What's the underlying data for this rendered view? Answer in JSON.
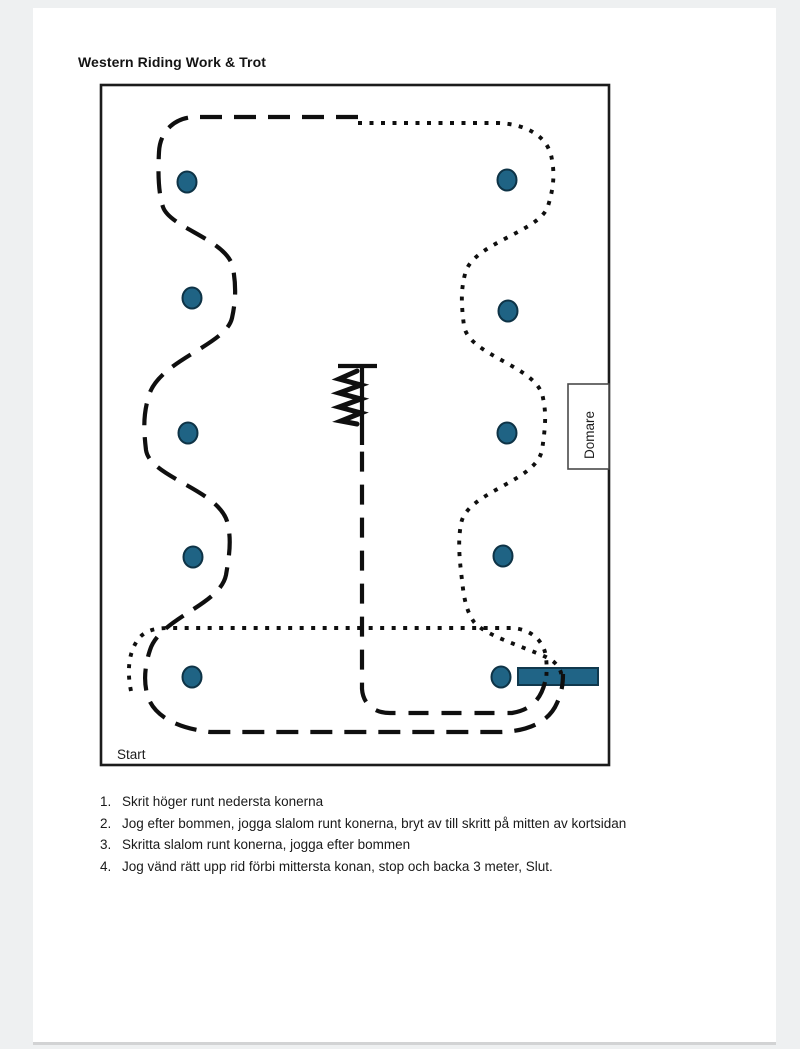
{
  "title": "Western Riding Work & Trot",
  "diagram": {
    "start_label": "Start",
    "judge_label": "Domare",
    "colors": {
      "cone_fill": "#1f6384",
      "pole_fill": "#206486",
      "path_color": "#0f0f0f"
    }
  },
  "instructions": {
    "items": [
      {
        "number": "1.",
        "text": "Skrit höger runt nedersta konerna"
      },
      {
        "number": "2.",
        "text": "Jog efter bommen, jogga slalom runt konerna, bryt av till skritt på mitten av kortsidan"
      },
      {
        "number": "3.",
        "text": "Skritta slalom runt konerna, jogga efter bommen"
      },
      {
        "number": "4.",
        "text": "Jog vänd rätt upp rid förbi mittersta konan, stop och backa 3 meter, Slut."
      }
    ]
  }
}
